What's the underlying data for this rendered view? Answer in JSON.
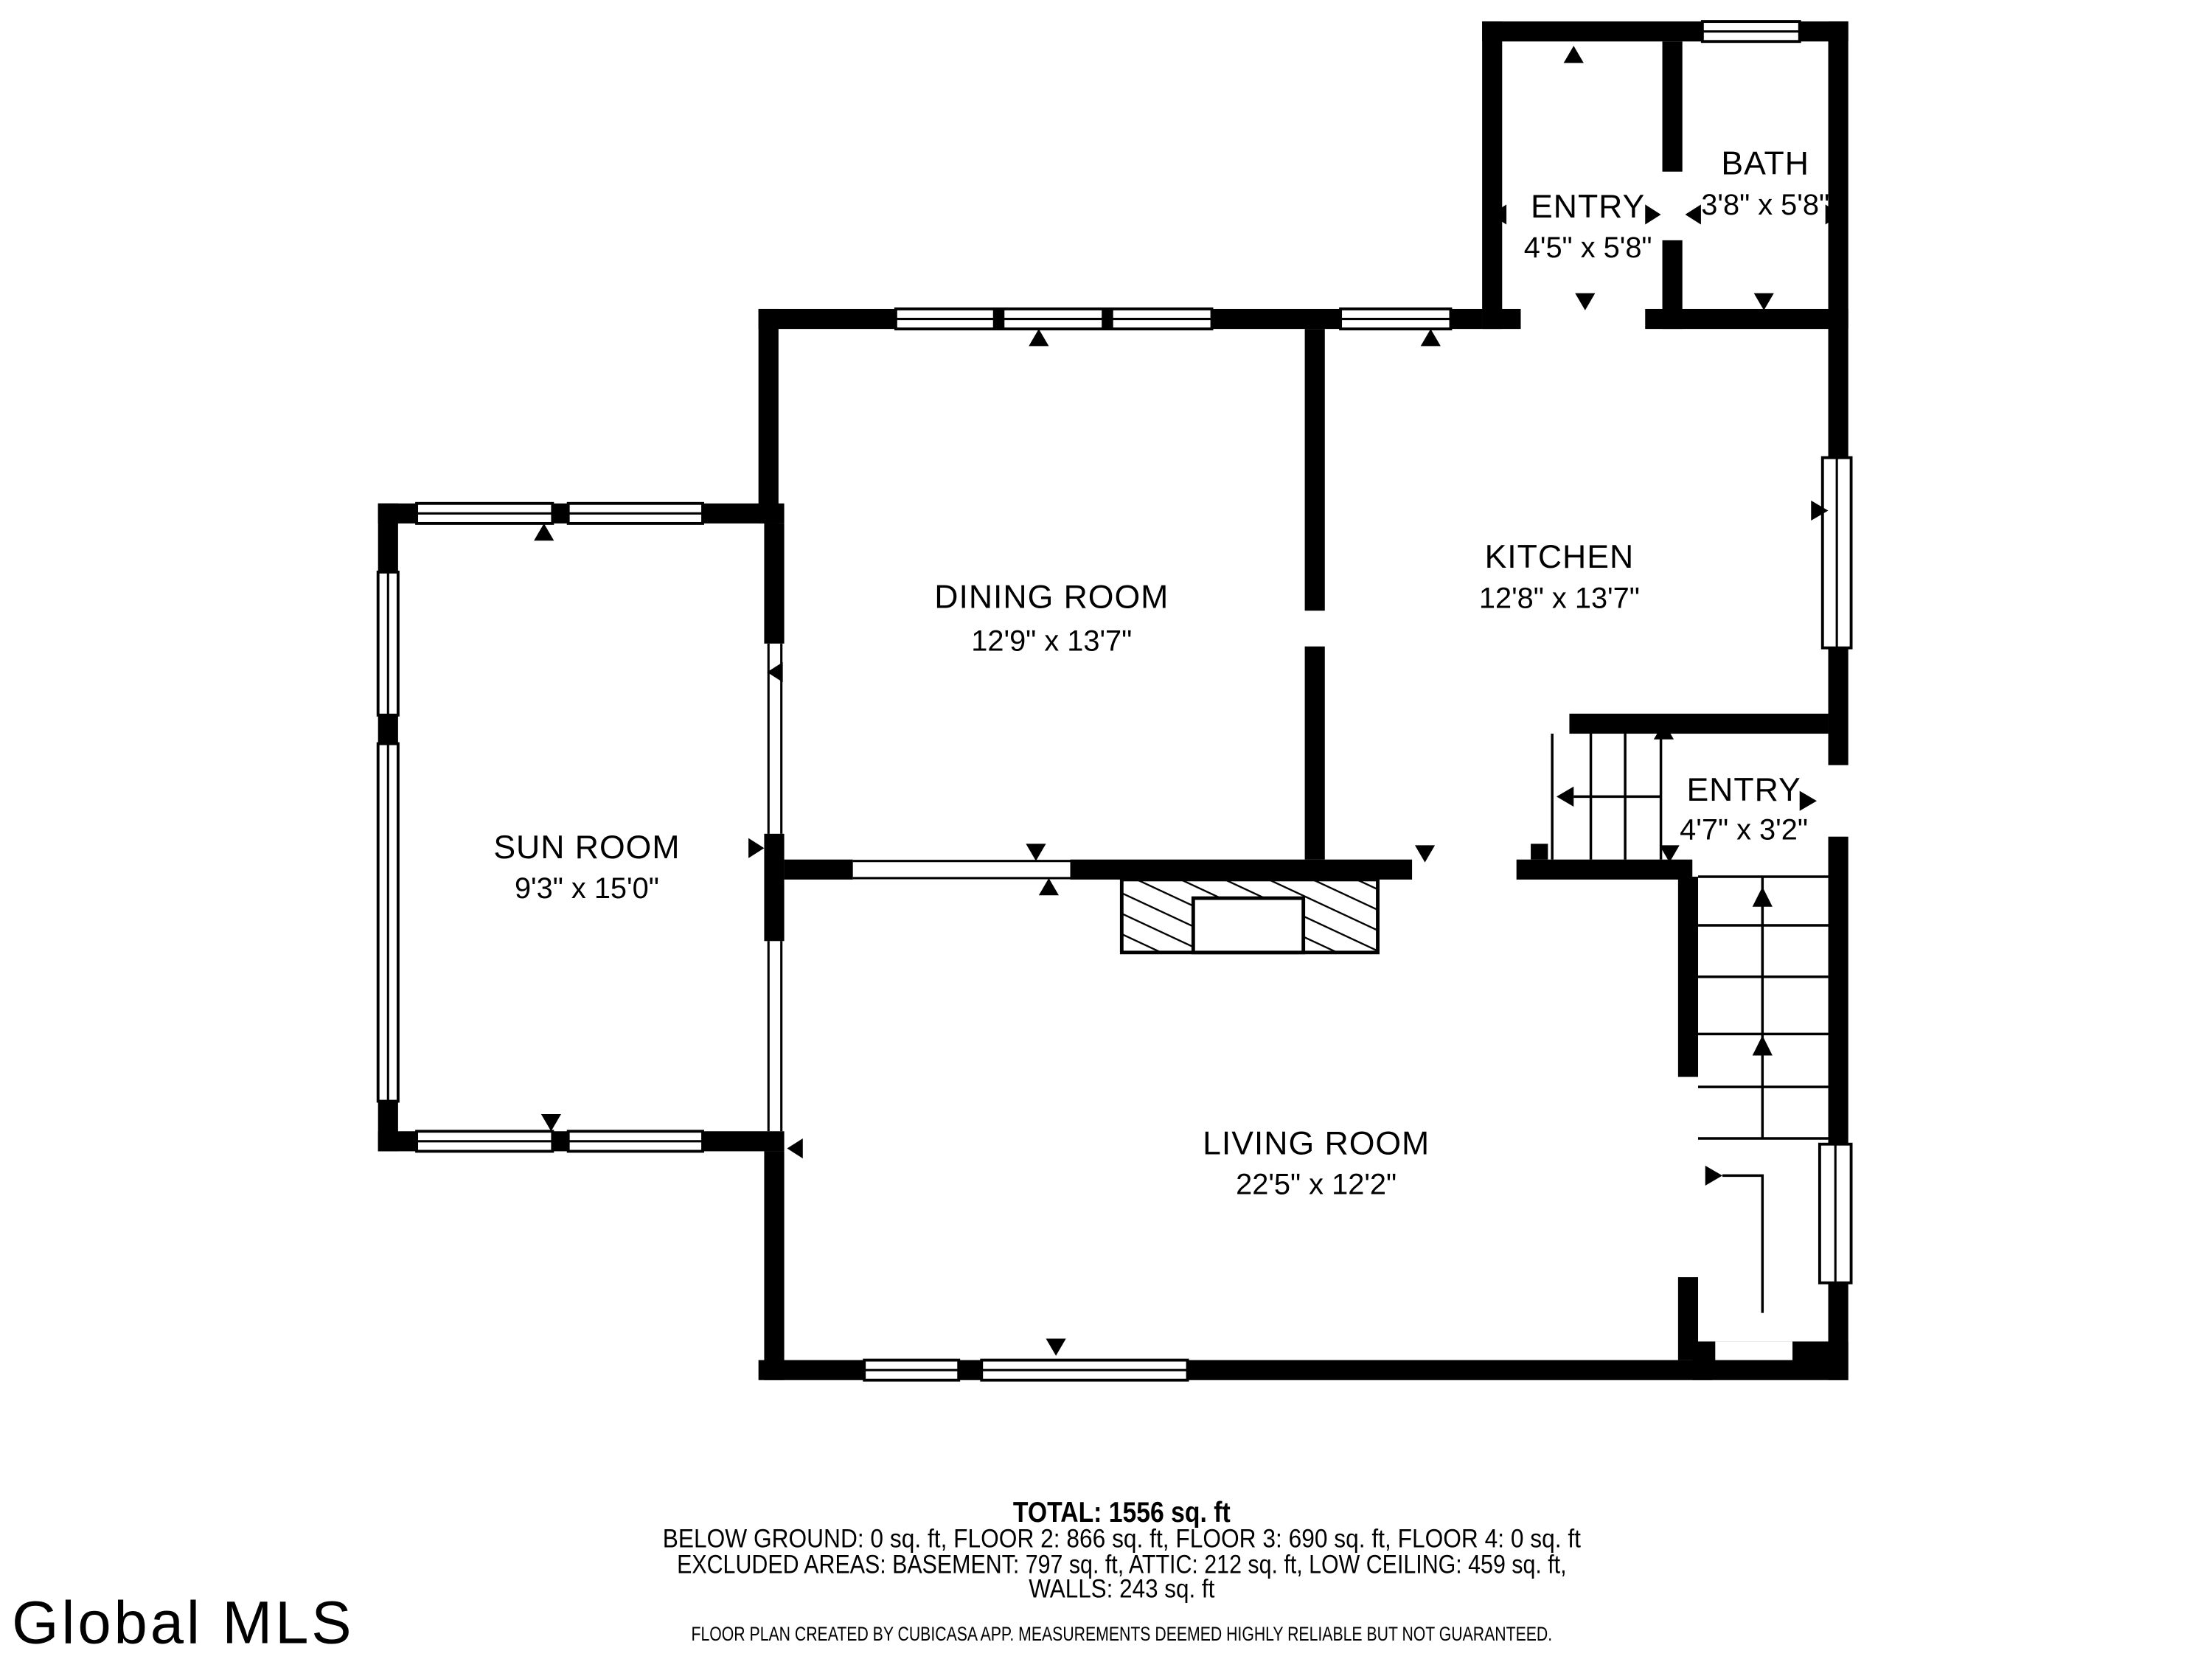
{
  "plan": {
    "rooms": [
      {
        "name": "ENTRY",
        "dims": "4'5\" x 5'8\""
      },
      {
        "name": "BATH",
        "dims": "3'8\" x 5'8\""
      },
      {
        "name": "DINING ROOM",
        "dims": "12'9\" x 13'7\""
      },
      {
        "name": "KITCHEN",
        "dims": "12'8\" x 13'7\""
      },
      {
        "name": "SUN ROOM",
        "dims": "9'3\" x 15'0\""
      },
      {
        "name": "ENTRY",
        "dims": "4'7\" x 3'2\""
      },
      {
        "name": "LIVING ROOM",
        "dims": "22'5\" x 12'2\""
      }
    ]
  },
  "summary": {
    "total": "TOTAL: 1556 sq. ft",
    "floors": "BELOW GROUND: 0 sq. ft, FLOOR 2: 866 sq. ft, FLOOR 3: 690 sq. ft, FLOOR 4: 0 sq. ft",
    "excluded": "EXCLUDED AREAS: BASEMENT: 797 sq. ft, ATTIC: 212 sq. ft, LOW CEILING: 459 sq. ft,",
    "walls": "WALLS: 243 sq. ft"
  },
  "disclaimer": "FLOOR PLAN CREATED BY CUBICASA APP. MEASUREMENTS DEEMED HIGHLY RELIABLE BUT NOT GUARANTEED.",
  "watermark": "Global MLS",
  "colors": {
    "wall": "#000000",
    "background": "#ffffff",
    "disclaimer_text": "#b2b2b2",
    "watermark_text": "#c9c9c9"
  }
}
